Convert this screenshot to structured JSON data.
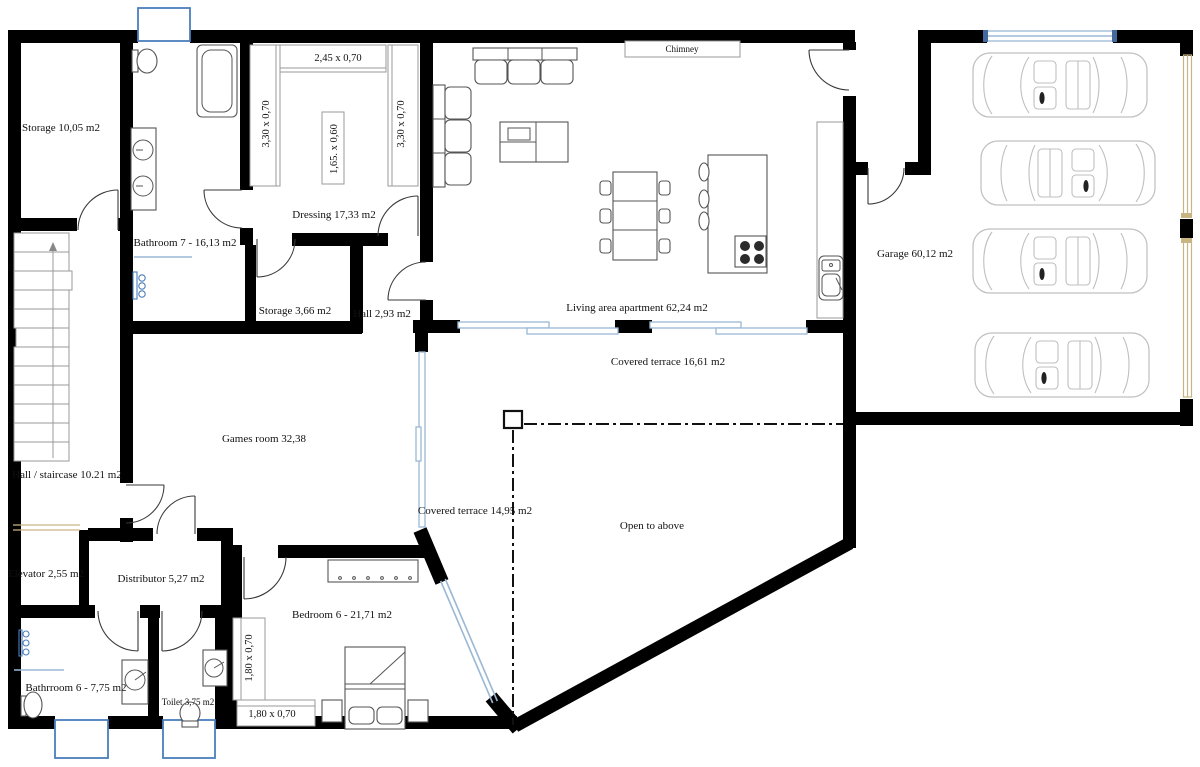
{
  "colors": {
    "wall": "#000000",
    "window": "#9ab8d6",
    "window_frame": "#4a7ebb",
    "garage_door_tan": "#c9b483",
    "furniture": "#555555",
    "car_outline": "#bfbfbf",
    "text": "#111111"
  },
  "labels": {
    "storage_top": "Storage 10,05 m2",
    "bathroom7": "Bathroom 7 - 16,13 m2",
    "dressing": "Dressing 17,33 m2",
    "chimney": "Chimney",
    "living": "Living area apartment 62,24 m2",
    "garage": "Garage 60,12 m2",
    "storage_small": "Storage 3,66 m2",
    "hall_small": "Hall 2,93 m2",
    "terrace_top": "Covered terrace 16,61 m2",
    "games_room": "Games room 32,38",
    "hall_staircase": "Hall / staircase 10.21 m2",
    "terrace_left": "Covered terrace 14,95 m2",
    "open_above": "Open to above",
    "elevator": "Elevator 2,55 m2",
    "distributor": "Distributor 5,27 m2",
    "bedroom": "Bedroom 6 - 21,71 m2",
    "bathroom6": "Bathrroom 6 -  7,75 m2",
    "toilet": "Toilet 3,75 m2"
  },
  "dimensions": {
    "dressing_top_closet": "2,45 x 0,70",
    "dressing_left_closet": "3,30 x 0,70",
    "dressing_island": "1,65. x 0,60",
    "dressing_right_closet": "3,30 x 0,70",
    "bedroom_closet_vertical": "1,80 x 0,70",
    "bedroom_closet_horizontal": "1,80 x 0,70"
  }
}
